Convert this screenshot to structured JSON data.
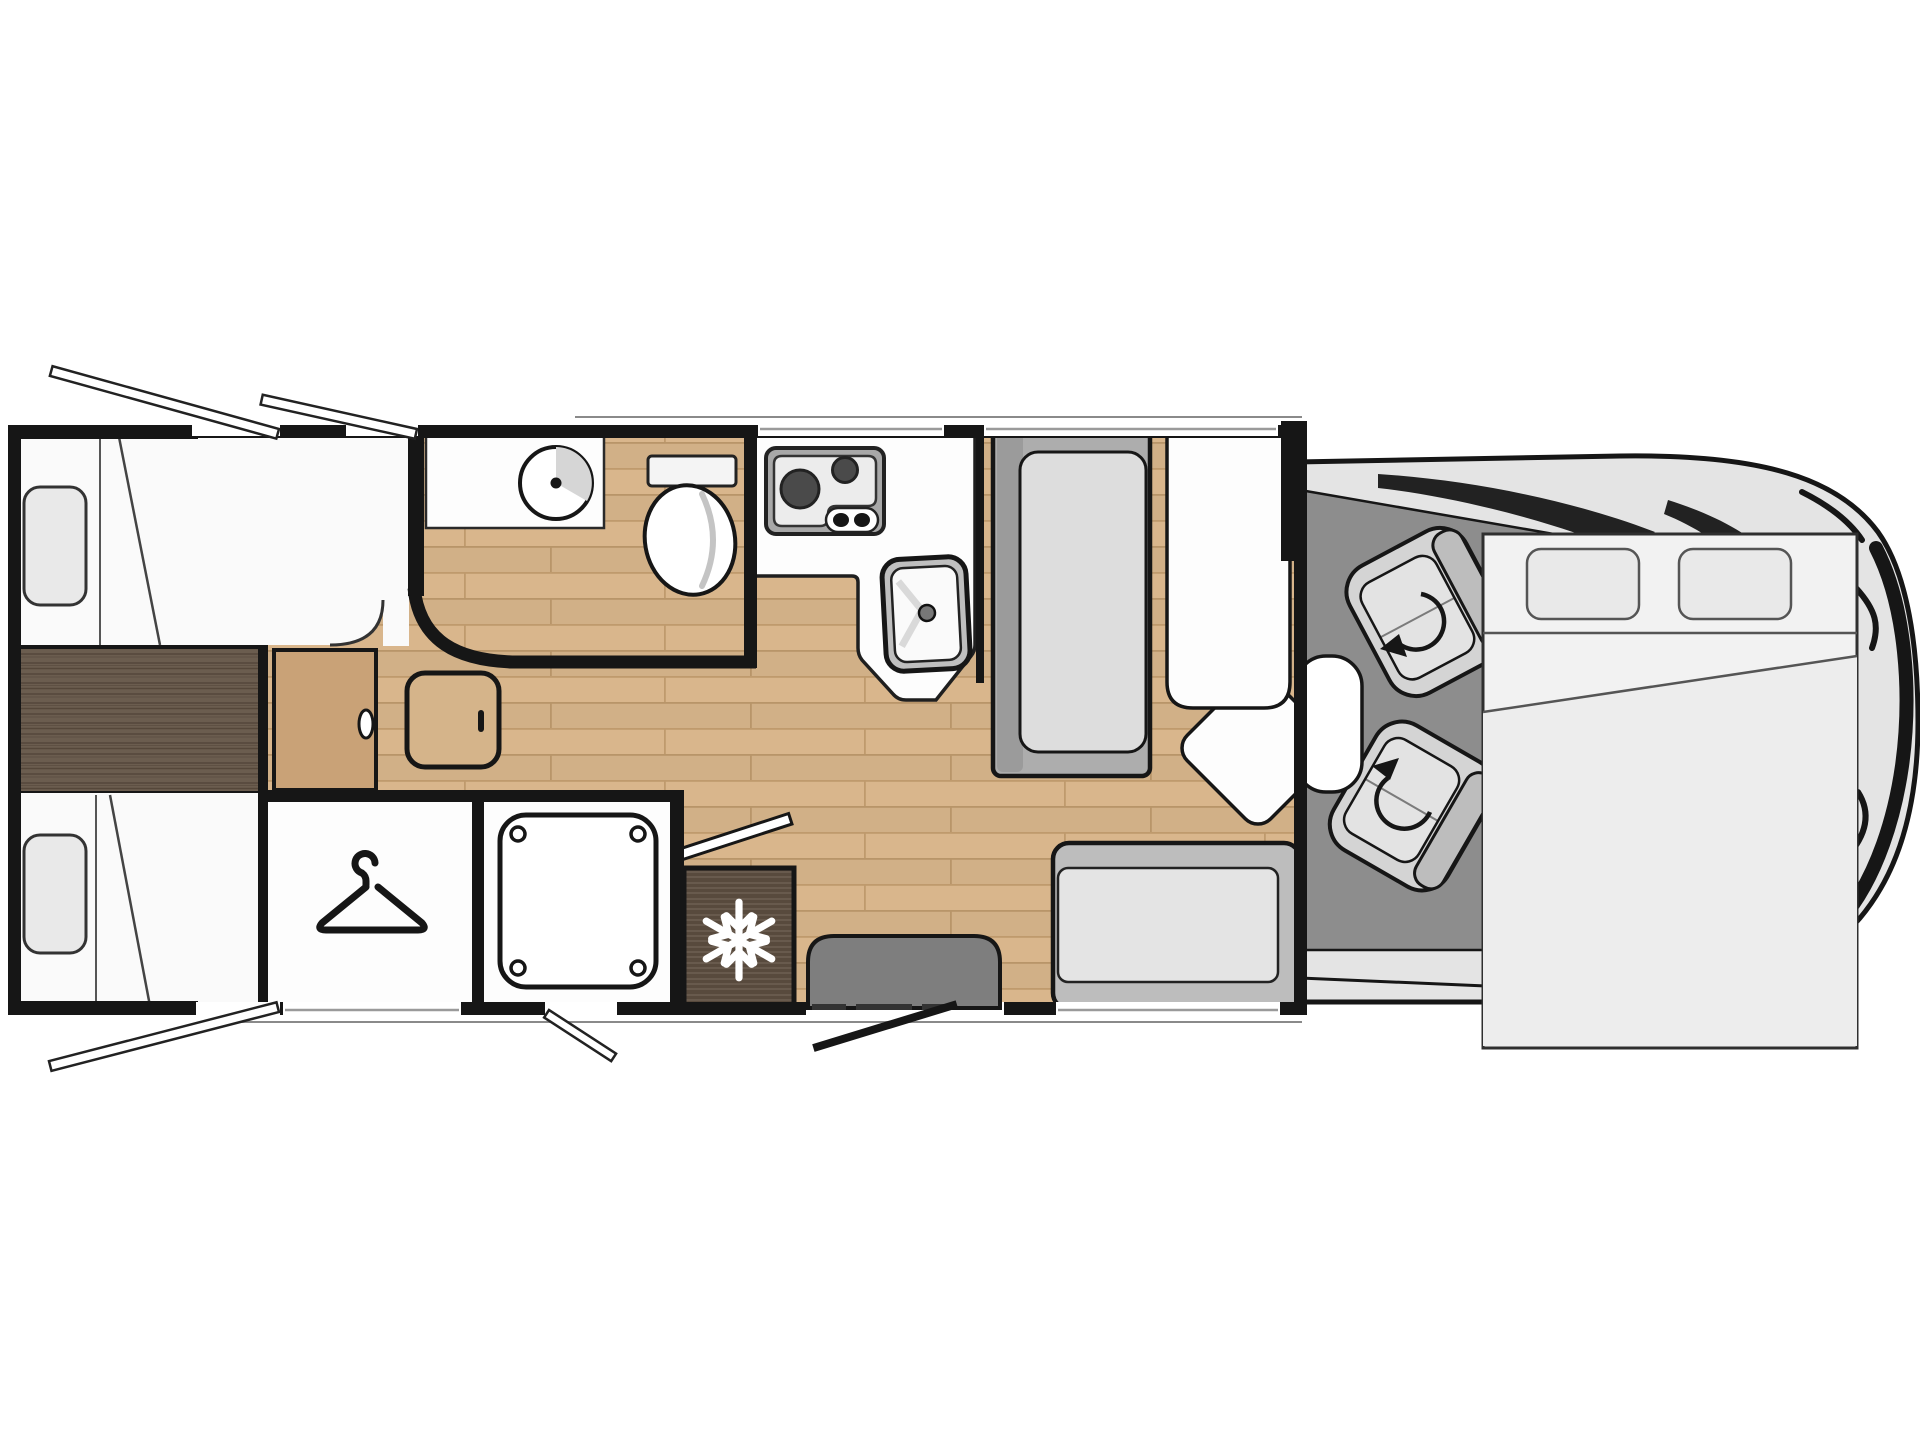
{
  "meta": {
    "type": "motorhome-floorplan-diagram",
    "view": "top-down",
    "orientation": "rear-left-cab-right"
  },
  "colors": {
    "wall": "#161616",
    "outline": "#161616",
    "wood_light": "#d9b68c",
    "wood_light_line": "#bf9a6d",
    "wood_dark": "#6b5d4f",
    "wood_dark_line": "#55473a",
    "fridge_wood": "#584a3d",
    "fridge_wood_line": "#6e6052",
    "room_white": "#fdfdfd",
    "furniture_white": "#fafafa",
    "pillow_grey": "#e9e9e9",
    "bench_back_grey": "#9b9b9b",
    "bench_grey": "#adadad",
    "cushion_grey": "#dddddd",
    "sofa_grey": "#bdbdbd",
    "sofa_cushion": "#e4e4e4",
    "cab_floor": "#8d8d8d",
    "cab_body": "#e4e4e4",
    "windshield_dark": "#222222",
    "seat_grey": "#d4d4d4",
    "seat_back_grey": "#bdbdbd",
    "seat_cushion": "#e3e3e3",
    "step_grey": "#7e7e7e",
    "bed_overlay": "#f2f2f2",
    "bed_pillow": "#e9e9e9",
    "window_line": "#9a9a9a",
    "body_edge_line": "#8a8a8a",
    "burner_dark": "#4a4a4a",
    "stove_frame": "#a8a8a8",
    "door_leaf": "#c9a277",
    "snowflake_white": "#ffffff"
  },
  "areas": {
    "rear_bedroom": {
      "name": "rear twin bedroom",
      "beds": [
        {
          "name": "offside single bed",
          "pillows": 1
        },
        {
          "name": "nearside single bed",
          "pillows": 1
        }
      ],
      "deck": "center wood deck",
      "step": "bedside step unit",
      "sliding_door": "bedroom sliding door"
    },
    "wardrobe": {
      "name": "wardrobe",
      "icon": "hanger-icon"
    },
    "washroom": {
      "name": "washroom",
      "fixtures": [
        "round washbasin",
        "toilet",
        "vanity counter"
      ]
    },
    "shower": {
      "name": "shower cubicle",
      "fixtures": [
        "shower tray with corner jets"
      ]
    },
    "kitchen": {
      "name": "kitchen",
      "fixtures": [
        "two-burner hob",
        "hob control knobs",
        "sink with tap",
        "L-shaped worktop"
      ]
    },
    "fridge": {
      "name": "refrigerator",
      "icon": "snowflake-icon"
    },
    "dinette": {
      "name": "dinette",
      "fixtures": [
        "forward-facing bench",
        "pedestal table with swivel leaf",
        "corner seat",
        "side sofa bench"
      ]
    },
    "entrance": {
      "name": "entrance",
      "fixtures": [
        "entry step",
        "open entry door"
      ]
    },
    "cab": {
      "name": "driver cab",
      "fixtures": [
        "swivel seat front",
        "swivel seat rear",
        "rotation arrows",
        "windscreen",
        "vehicle nose"
      ],
      "overlay": "drop-down bed",
      "bed_pillows": 2
    }
  },
  "windows": {
    "open_top": 2,
    "open_bottom": 2,
    "closed_top": [
      "kitchen window",
      "dinette window"
    ],
    "closed_bottom": [
      "bedroom window",
      "sofa window"
    ]
  }
}
